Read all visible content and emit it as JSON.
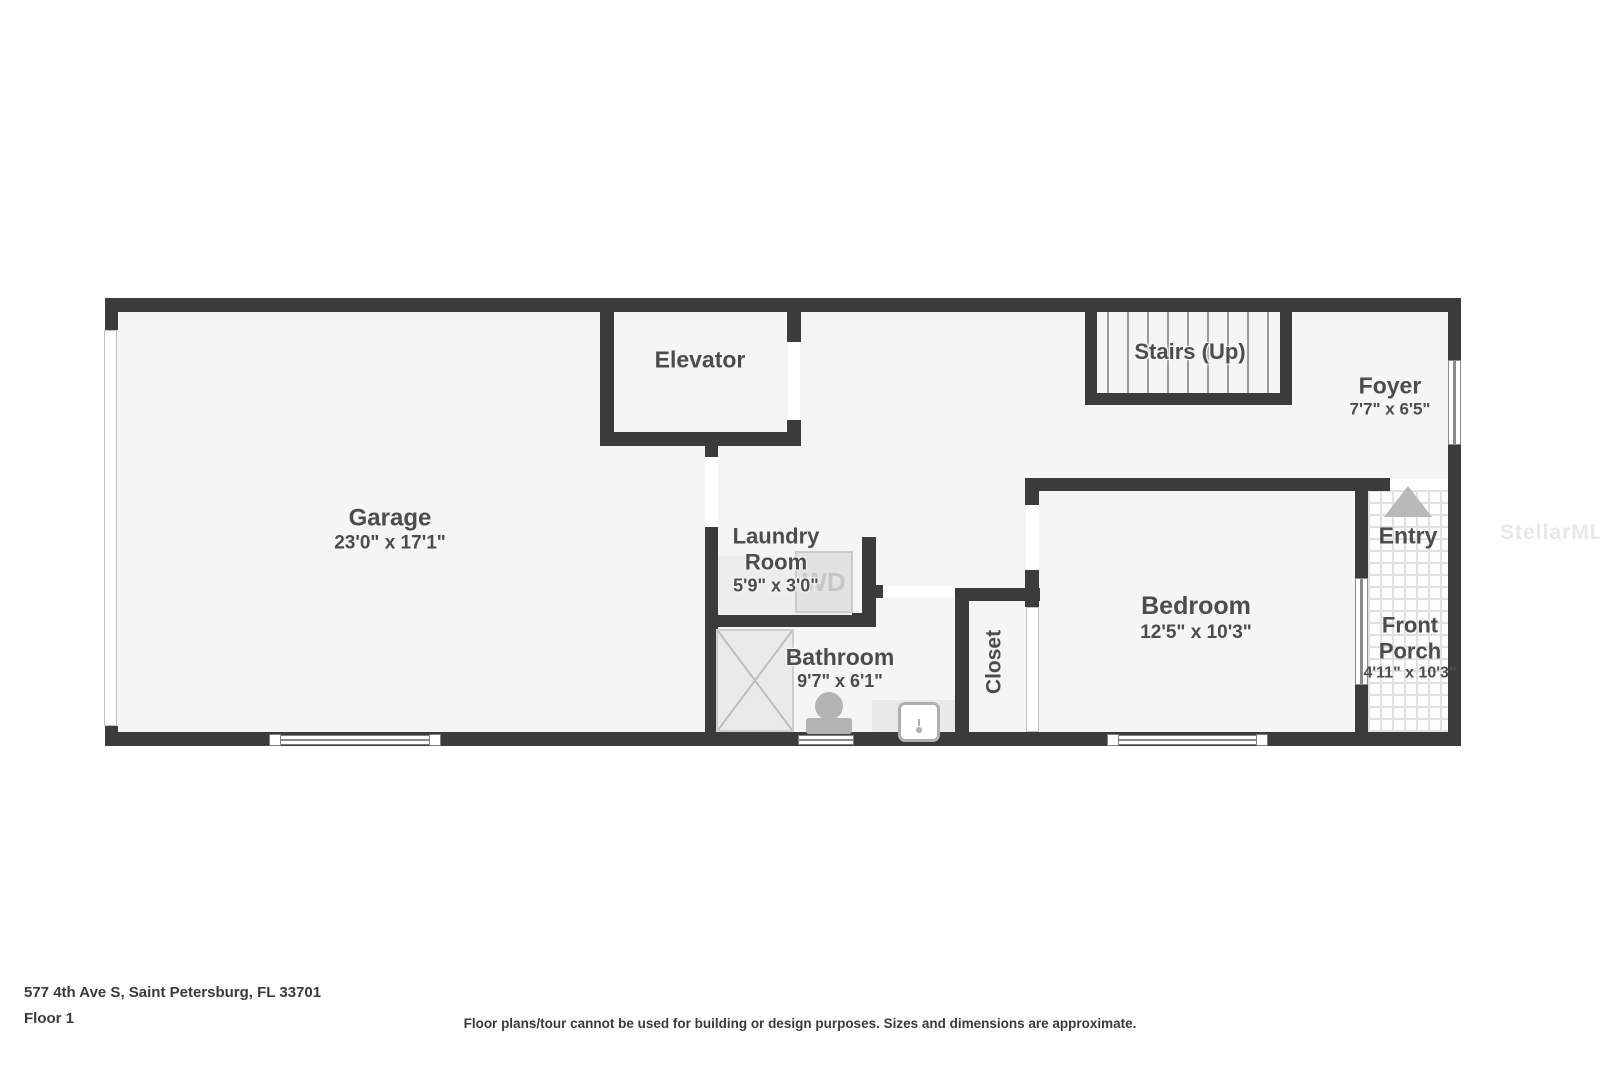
{
  "rooms": {
    "garage": {
      "name": "Garage",
      "dims": "23'0\" x 17'1\""
    },
    "elevator": {
      "name": "Elevator"
    },
    "laundry": {
      "line1": "Laundry",
      "line2": "Room",
      "dims": "5'9\" x 3'0\""
    },
    "bathroom": {
      "name": "Bathroom",
      "dims": "9'7\" x 6'1\""
    },
    "closet": {
      "name": "Closet"
    },
    "bedroom": {
      "name": "Bedroom",
      "dims": "12'5\" x 10'3\""
    },
    "stairs": {
      "name": "Stairs (Up)"
    },
    "foyer": {
      "name": "Foyer",
      "dims": "7'7\" x 6'5\""
    },
    "entry": {
      "name": "Entry"
    },
    "front_porch": {
      "line1": "Front",
      "line2": "Porch",
      "dims": "4'11\" x 10'3\""
    }
  },
  "fixtures": {
    "washer_dryer": "WD"
  },
  "footer": {
    "address": "577 4th Ave S, Saint Petersburg, FL 33701",
    "floor_label": "Floor 1",
    "disclaimer": "Floor plans/tour cannot be used for building or design purposes. Sizes and dimensions are approximate."
  },
  "watermark": {
    "text": "StellarMLS"
  },
  "colors": {
    "wall": "#3b3b3b",
    "floor": "#f5f5f5",
    "label_text": "#4c4c4c",
    "fixture_gray": "#b3b3b3",
    "watermark": "#e8e8e8"
  }
}
